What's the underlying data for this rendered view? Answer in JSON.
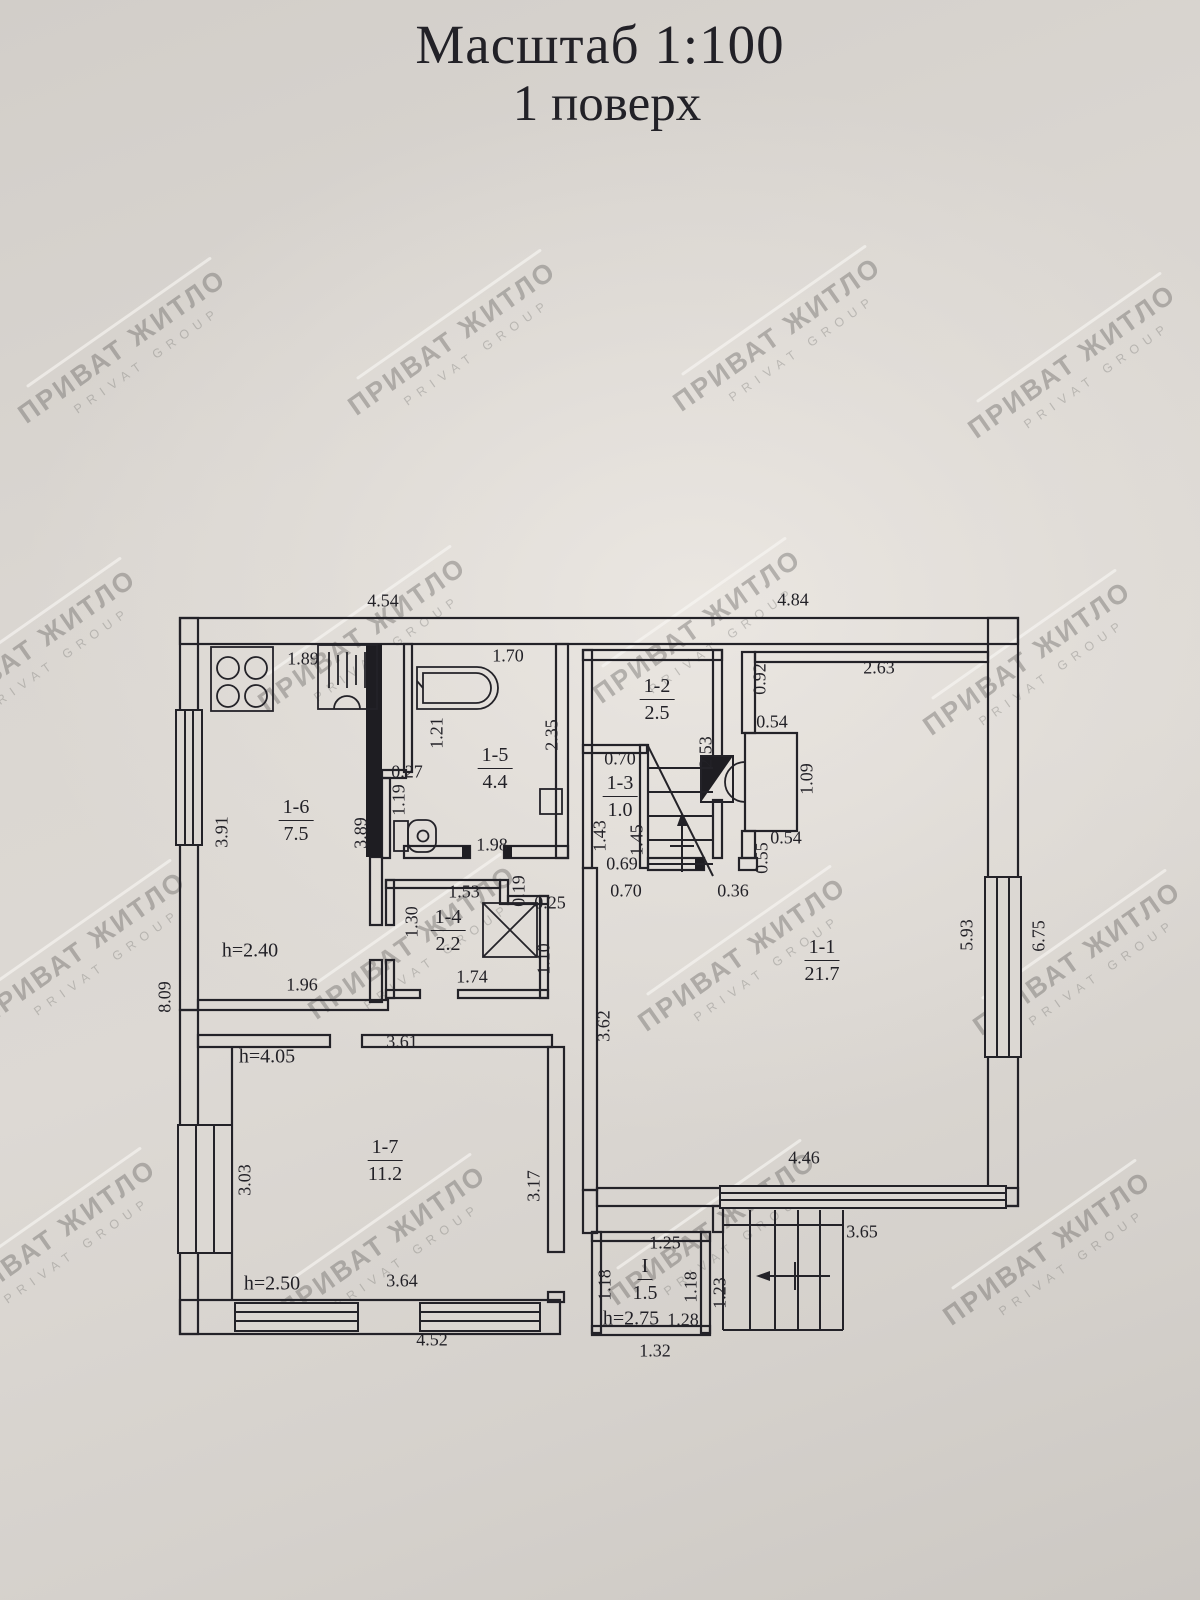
{
  "title": {
    "line1": "Масштаб 1:100",
    "line2": "1 поверх"
  },
  "watermark": {
    "line1": "ПРИВАТ ЖИТЛО",
    "line2": "PRIVAT GROUP",
    "positions": [
      [
        125,
        350
      ],
      [
        455,
        342
      ],
      [
        780,
        338
      ],
      [
        1075,
        365
      ],
      [
        35,
        650
      ],
      [
        365,
        638
      ],
      [
        700,
        630
      ],
      [
        1030,
        662
      ],
      [
        85,
        952
      ],
      [
        415,
        946
      ],
      [
        745,
        958
      ],
      [
        1080,
        962
      ],
      [
        55,
        1240
      ],
      [
        385,
        1246
      ],
      [
        715,
        1232
      ],
      [
        1050,
        1252
      ]
    ]
  },
  "plan": {
    "scale_note": "1:100",
    "floor_note": "1 поверх",
    "rooms": [
      {
        "id": "1-6",
        "area": "7.5",
        "x": 296,
        "y": 821
      },
      {
        "id": "1-5",
        "area": "4.4",
        "x": 495,
        "y": 769
      },
      {
        "id": "1-2",
        "area": "2.5",
        "x": 657,
        "y": 700
      },
      {
        "id": "1-3",
        "area": "1.0",
        "x": 620,
        "y": 797
      },
      {
        "id": "1-4",
        "area": "2.2",
        "x": 448,
        "y": 931
      },
      {
        "id": "1-1",
        "area": "21.7",
        "x": 822,
        "y": 961
      },
      {
        "id": "1-7",
        "area": "11.2",
        "x": 385,
        "y": 1161
      },
      {
        "id": "I",
        "area": "1.5",
        "x": 645,
        "y": 1280
      }
    ],
    "heights": [
      {
        "t": "h=2.40",
        "x": 250,
        "y": 951
      },
      {
        "t": "h=4.05",
        "x": 267,
        "y": 1057
      },
      {
        "t": "h=2.50",
        "x": 272,
        "y": 1284
      },
      {
        "t": "h=2.75",
        "x": 631,
        "y": 1319
      }
    ],
    "dims": [
      {
        "t": "4.54",
        "x": 383,
        "y": 601,
        "r": 0
      },
      {
        "t": "4.84",
        "x": 793,
        "y": 600,
        "r": 0
      },
      {
        "t": "8.09",
        "x": 165,
        "y": 997,
        "r": -90
      },
      {
        "t": "1.89",
        "x": 303,
        "y": 659,
        "r": 0
      },
      {
        "t": "3.91",
        "x": 222,
        "y": 832,
        "r": -90
      },
      {
        "t": "3.89",
        "x": 361,
        "y": 833,
        "r": -90
      },
      {
        "t": "1.96",
        "x": 302,
        "y": 985,
        "r": 0
      },
      {
        "t": "1.70",
        "x": 508,
        "y": 656,
        "r": 0
      },
      {
        "t": "1.21",
        "x": 437,
        "y": 733,
        "r": -90
      },
      {
        "t": "2.35",
        "x": 552,
        "y": 735,
        "r": -90
      },
      {
        "t": "0.27",
        "x": 407,
        "y": 772,
        "r": 0
      },
      {
        "t": "1.19",
        "x": 399,
        "y": 800,
        "r": -90
      },
      {
        "t": "1.98",
        "x": 492,
        "y": 845,
        "r": 0
      },
      {
        "t": "0.70",
        "x": 620,
        "y": 759,
        "r": 0
      },
      {
        "t": "1.43",
        "x": 600,
        "y": 836,
        "r": -90
      },
      {
        "t": "1.45",
        "x": 637,
        "y": 840,
        "r": -90
      },
      {
        "t": "0.69",
        "x": 622,
        "y": 864,
        "r": 0
      },
      {
        "t": "0.70",
        "x": 626,
        "y": 891,
        "r": 0
      },
      {
        "t": "0.36",
        "x": 733,
        "y": 891,
        "r": 0
      },
      {
        "t": "2.53",
        "x": 706,
        "y": 752,
        "r": -90
      },
      {
        "t": "0.92",
        "x": 760,
        "y": 679,
        "r": -90
      },
      {
        "t": "0.54",
        "x": 772,
        "y": 722,
        "r": 0
      },
      {
        "t": "1.09",
        "x": 807,
        "y": 779,
        "r": -90
      },
      {
        "t": "0.54",
        "x": 786,
        "y": 838,
        "r": 0
      },
      {
        "t": "0.55",
        "x": 762,
        "y": 858,
        "r": -90
      },
      {
        "t": "2.63",
        "x": 879,
        "y": 668,
        "r": 0
      },
      {
        "t": "3.62",
        "x": 604,
        "y": 1026,
        "r": -90
      },
      {
        "t": "5.93",
        "x": 967,
        "y": 935,
        "r": -90
      },
      {
        "t": "6.75",
        "x": 1039,
        "y": 936,
        "r": -90
      },
      {
        "t": "4.46",
        "x": 804,
        "y": 1158,
        "r": 0
      },
      {
        "t": "3.65",
        "x": 862,
        "y": 1232,
        "r": 0
      },
      {
        "t": "1.53",
        "x": 464,
        "y": 892,
        "r": 0
      },
      {
        "t": "1.30",
        "x": 412,
        "y": 922,
        "r": -90
      },
      {
        "t": "0.19",
        "x": 519,
        "y": 891,
        "r": -90
      },
      {
        "t": "0.25",
        "x": 550,
        "y": 903,
        "r": 0
      },
      {
        "t": "1.10",
        "x": 544,
        "y": 959,
        "r": -90
      },
      {
        "t": "1.74",
        "x": 472,
        "y": 977,
        "r": 0
      },
      {
        "t": "3.61",
        "x": 402,
        "y": 1042,
        "r": 0
      },
      {
        "t": "3.03",
        "x": 245,
        "y": 1180,
        "r": -90
      },
      {
        "t": "3.17",
        "x": 534,
        "y": 1186,
        "r": -90
      },
      {
        "t": "3.64",
        "x": 402,
        "y": 1281,
        "r": 0
      },
      {
        "t": "4.52",
        "x": 432,
        "y": 1340,
        "r": 0
      },
      {
        "t": "1.25",
        "x": 665,
        "y": 1243,
        "r": 0
      },
      {
        "t": "1.18",
        "x": 605,
        "y": 1285,
        "r": -90
      },
      {
        "t": "1.18",
        "x": 691,
        "y": 1287,
        "r": -90
      },
      {
        "t": "1.23",
        "x": 720,
        "y": 1293,
        "r": -90
      },
      {
        "t": "1.28",
        "x": 683,
        "y": 1320,
        "r": 0
      },
      {
        "t": "1.32",
        "x": 655,
        "y": 1351,
        "r": 0
      }
    ]
  }
}
